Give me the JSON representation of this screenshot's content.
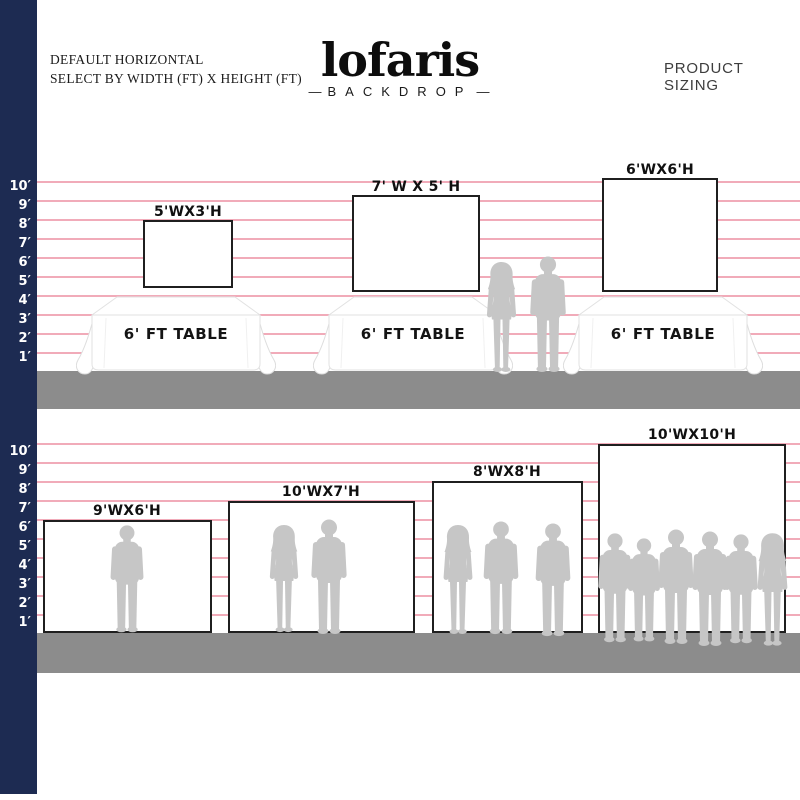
{
  "colors": {
    "navy": "#1d2b52",
    "pink": "#f1abb9",
    "floor": "#8c8c8c",
    "silhouette": "#c6c6c6"
  },
  "header": {
    "line1": "DEFAULT HORIZONTAL",
    "line2": "SELECT BY WIDTH (FT) X HEIGHT (FT)",
    "brand": "lofaris",
    "brand_sub": "BACKDROP",
    "dash": "—",
    "right_label": "PRODUCT SIZING"
  },
  "top_section": {
    "scale": [
      "10′",
      "9′",
      "8′",
      "7′",
      "6′",
      "5′",
      "4′",
      "3′",
      "2′",
      "1′"
    ],
    "backdrops": [
      {
        "label": "5'WX3'H"
      },
      {
        "label": "7' W X 5' H"
      },
      {
        "label": "6'WX6'H"
      }
    ],
    "tables": [
      {
        "label": "6' FT TABLE"
      },
      {
        "label": "6' FT TABLE"
      },
      {
        "label": "6' FT TABLE"
      }
    ]
  },
  "bottom_section": {
    "scale": [
      "10′",
      "9′",
      "8′",
      "7′",
      "6′",
      "5′",
      "4′",
      "3′",
      "2′",
      "1′"
    ],
    "backdrops": [
      {
        "label": "9'WX6'H"
      },
      {
        "label": "10'WX7'H"
      },
      {
        "label": "8'WX8'H"
      },
      {
        "label": "10'WX10'H"
      }
    ]
  }
}
